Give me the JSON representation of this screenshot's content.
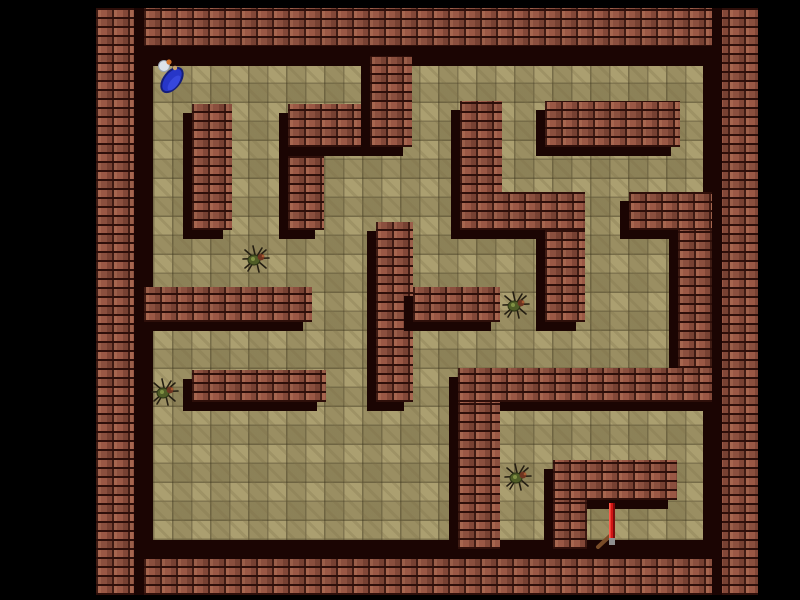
{
  "scene": {
    "width": 800,
    "height": 600,
    "background": "#000000"
  },
  "maze": {
    "x": 96,
    "y": 8,
    "width": 662,
    "height": 587,
    "floor_rect": {
      "x": 144,
      "y": 56,
      "width": 568,
      "height": 493
    },
    "colors": {
      "brick": "#9a5845",
      "brick_highlight": "#c08060",
      "mortar": "#2e0f0a",
      "bevel_shadow": "#1b0503",
      "floor": "#ab9f70",
      "floor_line": "#5c5230",
      "background": "#000000"
    }
  },
  "outer_walls": [
    {
      "id": "outer-wall-top",
      "x": 96,
      "y": 8,
      "w": 662,
      "h": 48,
      "bevel": "bottom"
    },
    {
      "id": "outer-wall-bottom",
      "x": 96,
      "y": 549,
      "w": 662,
      "h": 46,
      "bevel": "top"
    },
    {
      "id": "outer-wall-left",
      "x": 96,
      "y": 8,
      "w": 48,
      "h": 587,
      "bevel": "right"
    },
    {
      "id": "outer-wall-right",
      "x": 712,
      "y": 8,
      "w": 46,
      "h": 587,
      "bevel": "left"
    }
  ],
  "inner_walls": [
    {
      "id": "wall-left-column",
      "x": 192,
      "y": 104,
      "w": 40,
      "h": 126
    },
    {
      "id": "wall-zigzag-leg",
      "x": 288,
      "y": 104,
      "w": 36,
      "h": 126
    },
    {
      "id": "wall-zigzag-bar",
      "x": 288,
      "y": 104,
      "w": 124,
      "h": 43
    },
    {
      "id": "wall-top-hanger",
      "x": 370,
      "y": 56,
      "w": 42,
      "h": 91
    },
    {
      "id": "wall-mid-column",
      "x": 376,
      "y": 222,
      "w": 37,
      "h": 180
    },
    {
      "id": "wall-center-stem",
      "x": 460,
      "y": 101,
      "w": 42,
      "h": 129
    },
    {
      "id": "wall-center-foot",
      "x": 460,
      "y": 192,
      "w": 125,
      "h": 38
    },
    {
      "id": "wall-top-right-block",
      "x": 545,
      "y": 101,
      "w": 135,
      "h": 46
    },
    {
      "id": "wall-right-arm",
      "x": 629,
      "y": 192,
      "w": 83,
      "h": 38
    },
    {
      "id": "wall-right-leg",
      "x": 678,
      "y": 230,
      "w": 34,
      "h": 138
    },
    {
      "id": "wall-center-down",
      "x": 545,
      "y": 230,
      "w": 40,
      "h": 92
    },
    {
      "id": "wall-long-left",
      "x": 144,
      "y": 287,
      "w": 168,
      "h": 35
    },
    {
      "id": "wall-long-right",
      "x": 413,
      "y": 287,
      "w": 87,
      "h": 35
    },
    {
      "id": "wall-lower-mid",
      "x": 192,
      "y": 370,
      "w": 134,
      "h": 32
    },
    {
      "id": "wall-lower-long",
      "x": 458,
      "y": 368,
      "w": 254,
      "h": 34
    },
    {
      "id": "wall-lower-stem",
      "x": 458,
      "y": 402,
      "w": 42,
      "h": 147
    },
    {
      "id": "wall-bottom-right-arm",
      "x": 553,
      "y": 460,
      "w": 124,
      "h": 40
    },
    {
      "id": "wall-bottom-right-leg",
      "x": 553,
      "y": 500,
      "w": 34,
      "h": 49
    }
  ],
  "entities": {
    "player": {
      "id": "player",
      "kind": "player",
      "x": 152,
      "y": 56,
      "w": 36,
      "h": 40,
      "colors": {
        "robe": "#2736c8",
        "robe_dark": "#141d7a",
        "head": "#dde3ea",
        "hair": "#d2722a"
      }
    },
    "enemies": [
      {
        "id": "spider-1",
        "kind": "spider",
        "x": 242,
        "y": 245,
        "w": 28,
        "h": 28
      },
      {
        "id": "spider-2",
        "kind": "spider",
        "x": 502,
        "y": 291,
        "w": 28,
        "h": 28
      },
      {
        "id": "spider-3",
        "kind": "spider",
        "x": 151,
        "y": 378,
        "w": 28,
        "h": 28
      },
      {
        "id": "spider-4",
        "kind": "spider",
        "x": 504,
        "y": 463,
        "w": 28,
        "h": 28
      }
    ],
    "items": [
      {
        "id": "sword",
        "kind": "sword",
        "x": 594,
        "y": 501,
        "w": 30,
        "h": 48,
        "colors": {
          "blade": "#d01414",
          "blade_dark": "#7c0b0b",
          "hilt": "#7a4c28"
        }
      }
    ]
  }
}
